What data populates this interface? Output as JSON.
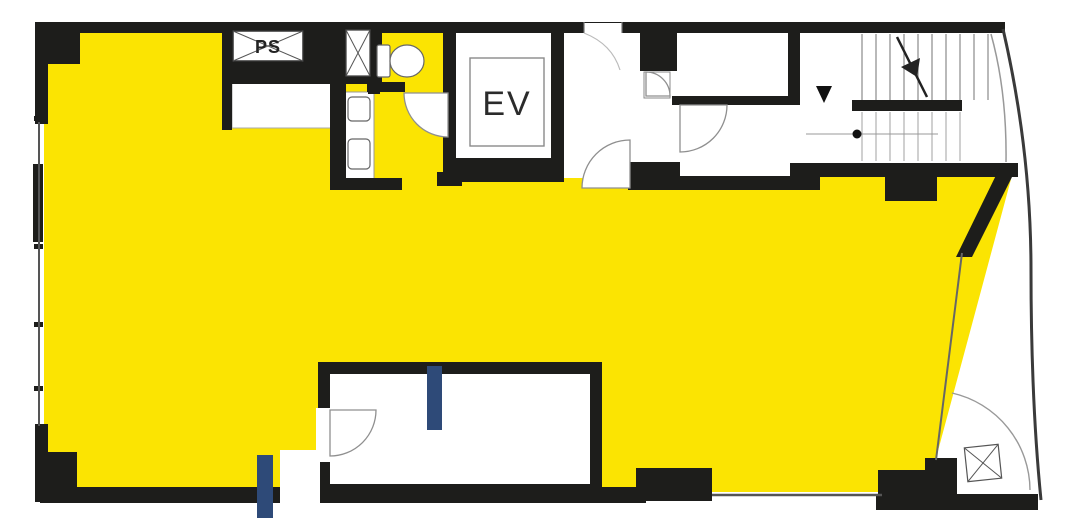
{
  "plan": {
    "type": "building-floor-plan",
    "labels": {
      "pipe_shaft": "PS",
      "elevator": "EV"
    },
    "colors": {
      "highlight_area": "#fbe402",
      "wall": "#1d1d1b",
      "door_bar": "#2e4a78",
      "background": "#ffffff"
    },
    "features": [
      "leased-area-highlight",
      "pipe-shaft",
      "duct-shaft",
      "toilet",
      "wash-basins",
      "elevator-shaft",
      "elevator-hall",
      "corridor",
      "staircase-with-direction-arrow",
      "curved-facade",
      "entrance-door-swing",
      "interior-room",
      "door-swings",
      "window-walls",
      "blue-door-bars"
    ]
  }
}
